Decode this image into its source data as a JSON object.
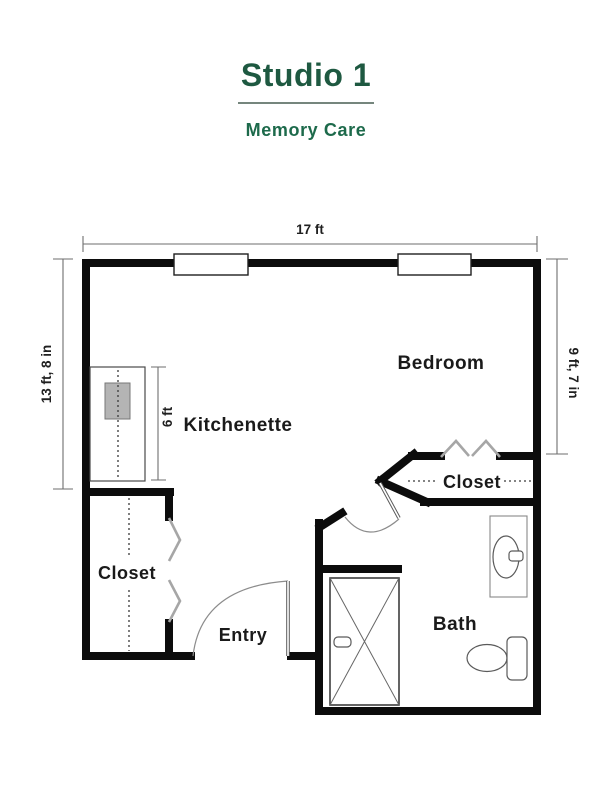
{
  "header": {
    "title": "Studio 1",
    "subtitle": "Memory Care"
  },
  "labels": {
    "bedroom": "Bedroom",
    "kitchenette": "Kitchenette",
    "closet_left": "Closet",
    "closet_right": "Closet",
    "entry": "Entry",
    "bath": "Bath"
  },
  "dimensions": {
    "width_top": "17 ft",
    "height_left": "13 ft, 8 in",
    "height_right": "9 ft, 7 in",
    "kitchenette_counter": "6 ft"
  },
  "colors": {
    "title_green": "#1E5941",
    "subtitle_green": "#1D6A4B",
    "divider_gray_green": "#75867D",
    "wall_black": "#0C0C0C",
    "door_panel_gray": "#A6A6A6",
    "sink_fill_gray": "#B4B4B4"
  }
}
